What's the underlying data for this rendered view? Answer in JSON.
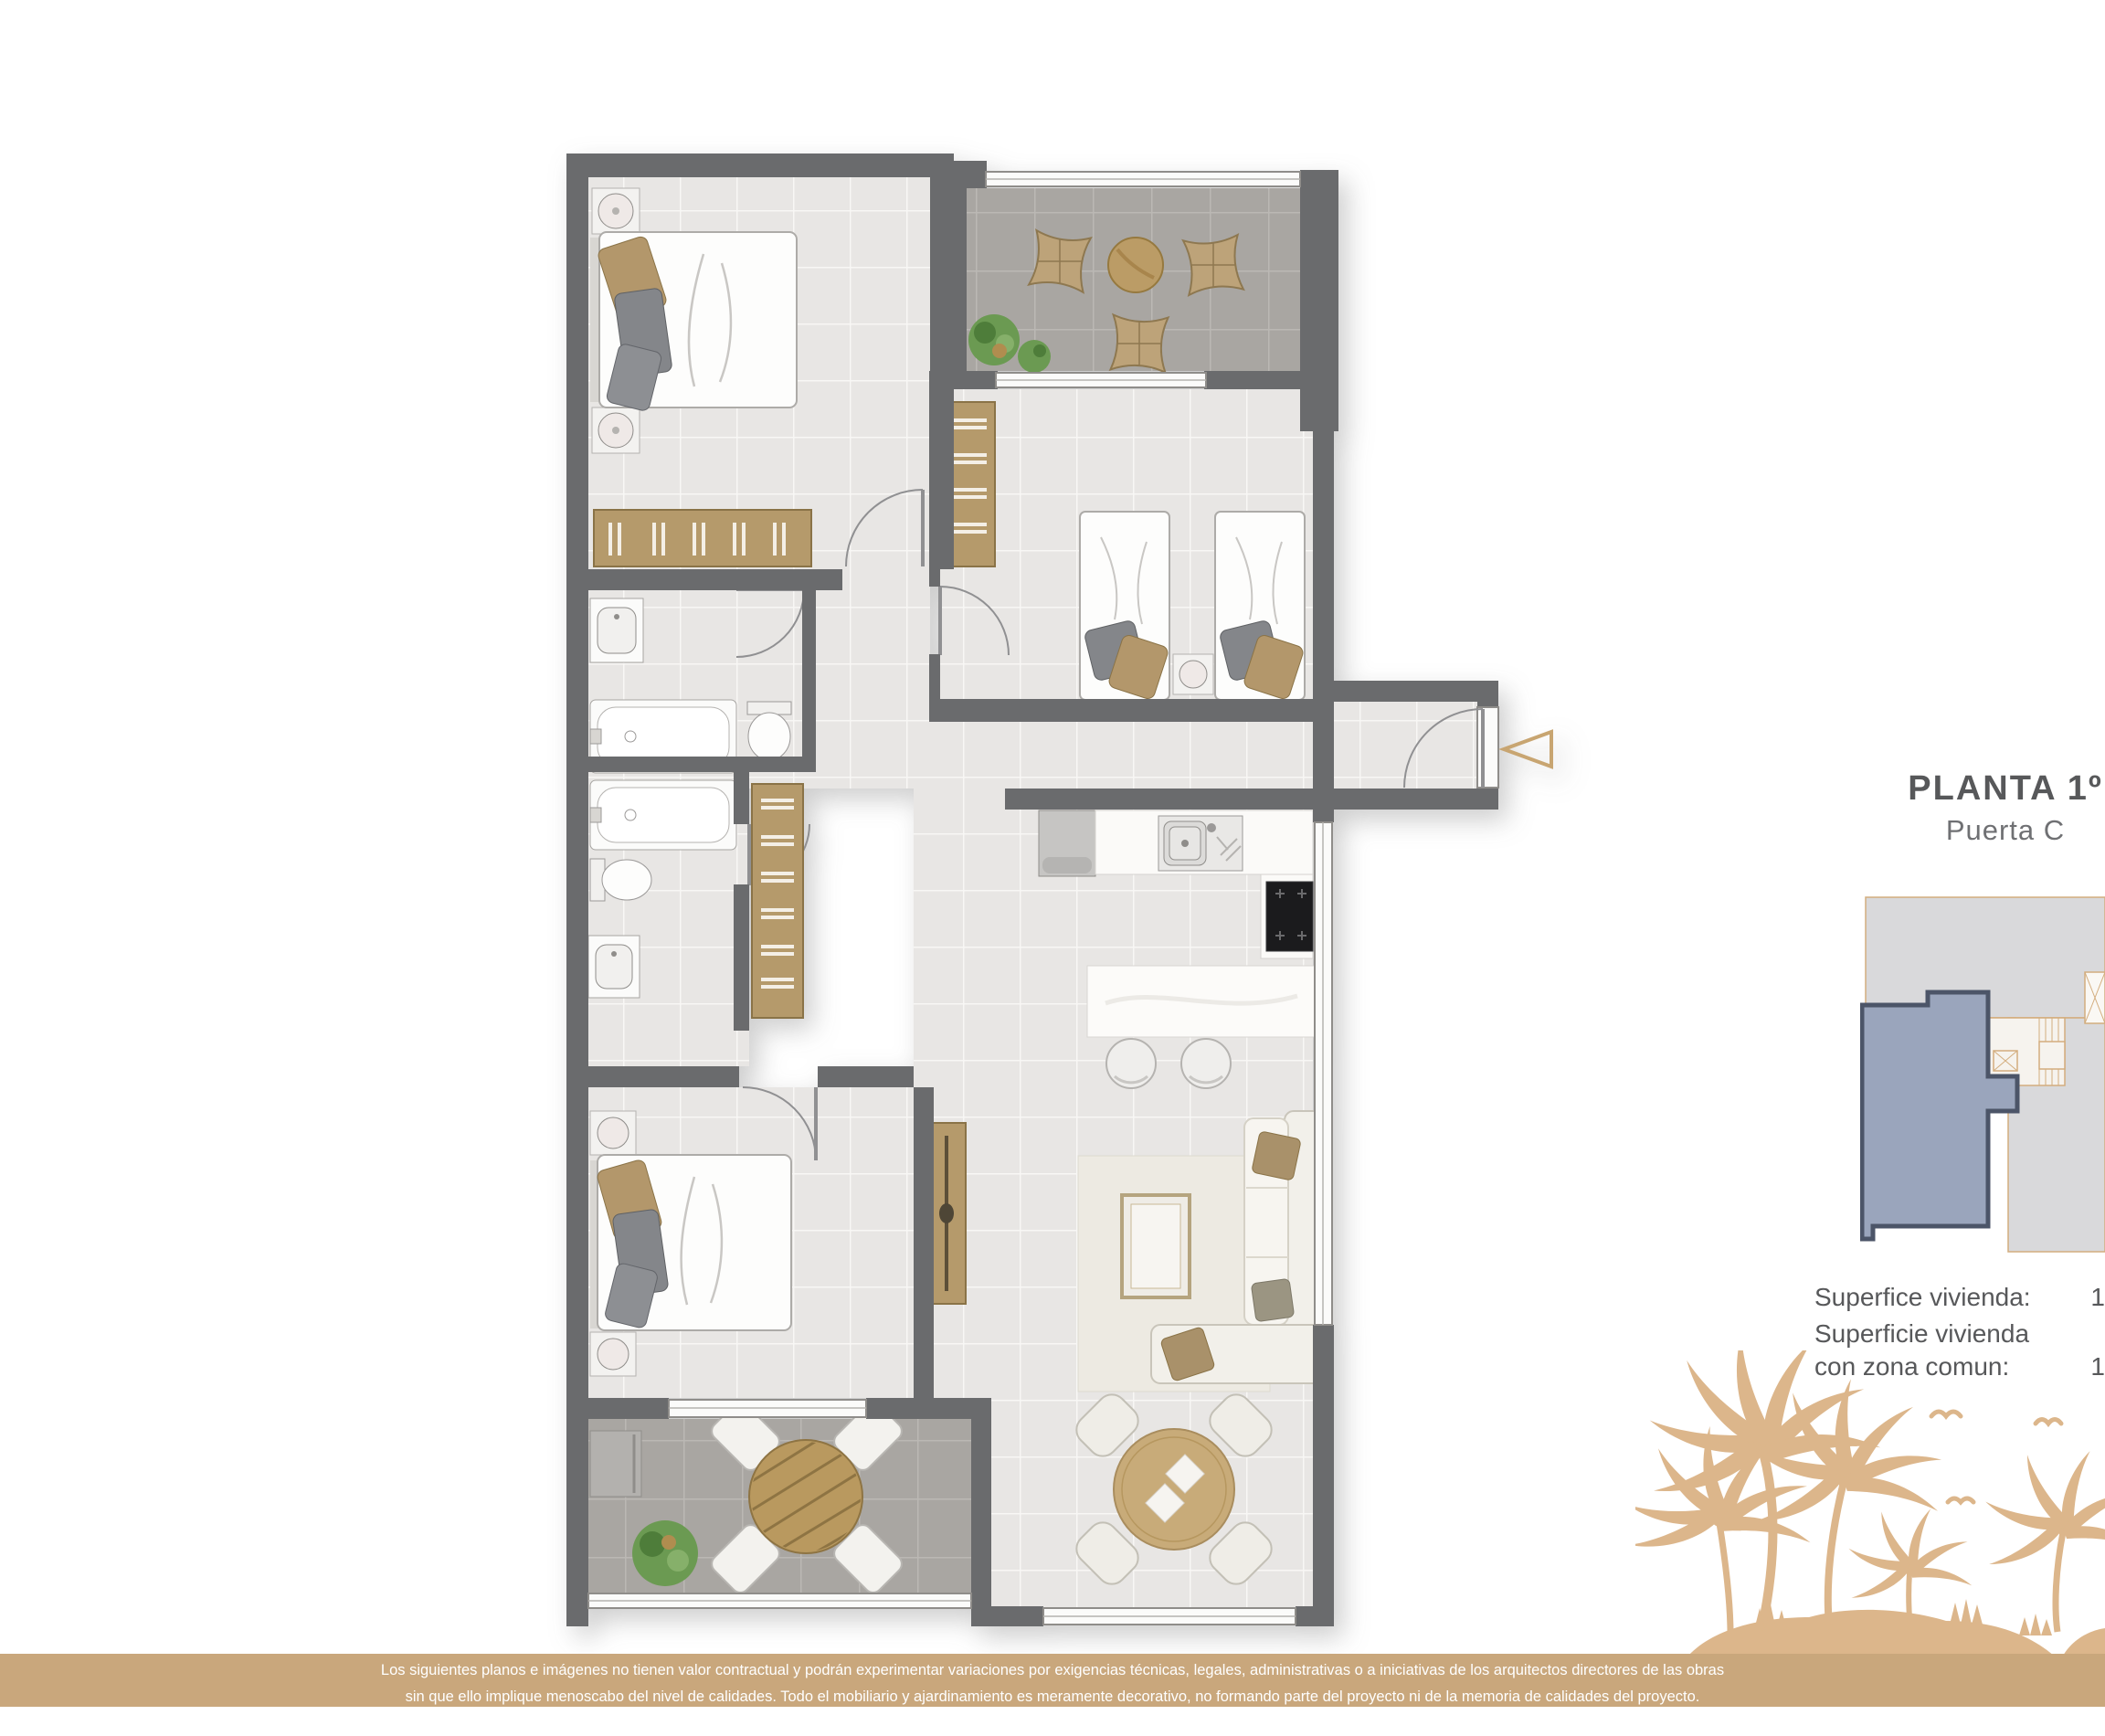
{
  "title": {
    "floor_label": "PLANTA 1º",
    "door_label": "Puerta C"
  },
  "surface": {
    "rows": [
      {
        "label": "Superfice vivienda:",
        "value": "1"
      },
      {
        "label": "Superficie vivienda con zona comun:",
        "value": "1"
      }
    ]
  },
  "disclaimer": {
    "line1": "Los siguientes planos e imágenes no tienen valor contractual y podrán experimentar variaciones por exigencias técnicas, legales, administrativas o a iniciativas de los arquitectos directores de las obras",
    "line2": "sin que ello implique menoscabo del nivel de calidades. Todo el mobiliario y ajardinamiento es meramente decorativo, no formando parte del proyecto ni de la memoria de calidades del proyecto."
  },
  "colors": {
    "accent_gold": "#c9a77c",
    "palm_silhouette": "#dcb68b",
    "wall_gray": "#6a6b6d",
    "floor_light": "#e8e6e4",
    "terrace_dark": "#a9a6a2",
    "wood_tan": "#b59a6b",
    "keyplan_highlight_fill": "#9aa5bc",
    "keyplan_highlight_border": "#4c5568",
    "text_dark": "#58595b",
    "entry_arrow_gold": "#c8a571"
  },
  "icons": {
    "entry_arrow": "triangle-left-outline",
    "plan_furniture": [
      "double-bed",
      "single-bed",
      "wardrobe",
      "bathtub",
      "toilet",
      "washbasin",
      "kitchen-sink",
      "cooktop",
      "fridge",
      "island-counter",
      "stool",
      "sofa",
      "coffee-table",
      "tv-sideboard",
      "round-dining-table",
      "chair",
      "lounge-chair",
      "round-terrace-table",
      "plant",
      "storage-box",
      "lamp"
    ]
  }
}
